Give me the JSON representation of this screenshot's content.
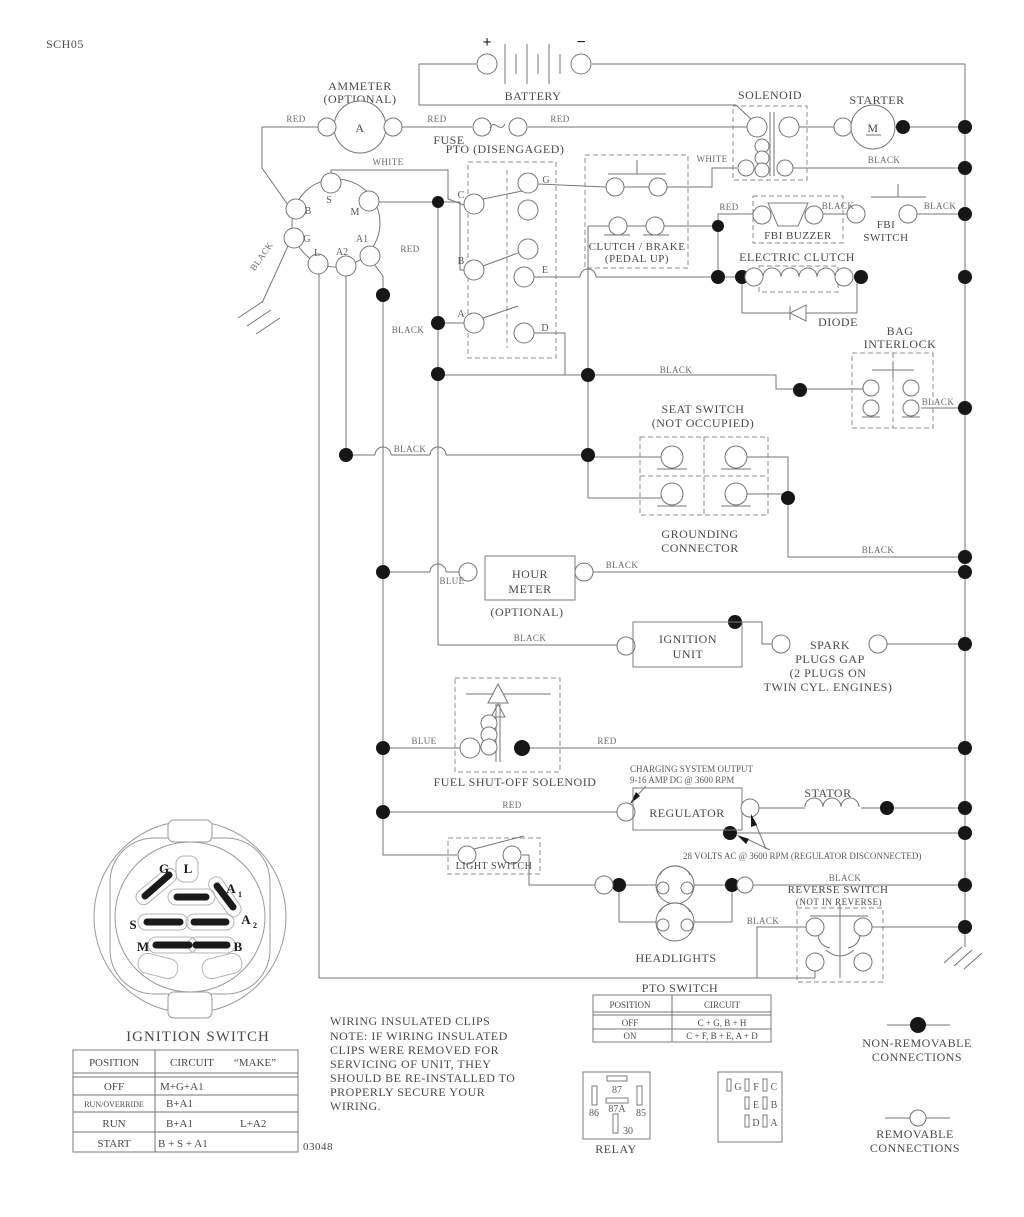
{
  "page": {
    "sch_code": "SCH05",
    "doc_number": "03048"
  },
  "battery": {
    "label": "BATTERY",
    "plus": "+",
    "minus": "−"
  },
  "ammeter": {
    "line1": "AMMETER",
    "line2": "(OPTIONAL)",
    "symbol": "A"
  },
  "fuse": {
    "label": "FUSE"
  },
  "pto": {
    "label": "PTO (DISENGAGED)",
    "pin_c": "C",
    "pin_b": "B",
    "pin_a": "A",
    "pin_g": "G",
    "pin_e": "E",
    "pin_d": "D"
  },
  "solenoid": {
    "label": "SOLENOID"
  },
  "starter": {
    "label": "STARTER",
    "symbol": "M"
  },
  "fbi_buzzer": {
    "label": "FBI BUZZER"
  },
  "fbi_switch": {
    "line1": "FBI",
    "line2": "SWITCH"
  },
  "clutch_brake": {
    "line1": "CLUTCH / BRAKE",
    "line2": "(PEDAL UP)"
  },
  "electric_clutch": {
    "label": "ELECTRIC CLUTCH"
  },
  "diode": {
    "label": "DIODE"
  },
  "bag_interlock": {
    "line1": "BAG",
    "line2": "INTERLOCK"
  },
  "seat_switch": {
    "line1": "SEAT SWITCH",
    "line2": "(NOT OCCUPIED)"
  },
  "grounding_connector": {
    "line1": "GROUNDING",
    "line2": "CONNECTOR"
  },
  "hour_meter": {
    "line1": "HOUR",
    "line2": "METER",
    "note": "(OPTIONAL)"
  },
  "ignition_unit": {
    "line1": "IGNITION",
    "line2": "UNIT"
  },
  "spark_plugs": {
    "line1": "SPARK",
    "line2": "PLUGS GAP",
    "line3": "(2 PLUGS ON",
    "line4": "TWIN CYL. ENGINES)"
  },
  "fuel_solenoid": {
    "label": "FUEL SHUT-OFF SOLENOID"
  },
  "regulator": {
    "label": "REGULATOR"
  },
  "stator": {
    "label": "STATOR"
  },
  "charging_note": {
    "line1": "CHARGING SYSTEM OUTPUT",
    "line2": "9-16 AMP DC @ 3600 RPM"
  },
  "volts_note": {
    "label": "28 VOLTS AC @ 3600 RPM (REGULATOR DISCONNECTED)"
  },
  "light_switch": {
    "label": "LIGHT SWITCH"
  },
  "headlights": {
    "label": "HEADLIGHTS"
  },
  "reverse_switch": {
    "line1": "REVERSE SWITCH",
    "line2": "(NOT IN REVERSE)"
  },
  "ignition_connector": {
    "pin_s": "S",
    "pin_m": "M",
    "pin_b": "B",
    "pin_g": "G",
    "pin_l": "L",
    "pin_a2": "A2",
    "pin_a1": "A1"
  },
  "ignition_face": {
    "title": "IGNITION SWITCH",
    "pin_g": "G",
    "pin_l": "L",
    "pin_a": "A",
    "sub_1": "1",
    "sub_2": "2",
    "pin_s": "S",
    "pin_m": "M",
    "pin_b": "B"
  },
  "ignition_table": {
    "h_position": "POSITION",
    "h_circuit": "CIRCUIT",
    "h_make": "“MAKE”",
    "rows": [
      {
        "position": "OFF",
        "circuit": "M+G+A1",
        "make": ""
      },
      {
        "position": "RUN/OVERRIDE",
        "circuit": "B+A1",
        "make": ""
      },
      {
        "position": "RUN",
        "circuit": "B+A1",
        "make": "L+A2"
      },
      {
        "position": "START",
        "circuit": "B + S + A1",
        "make": ""
      }
    ]
  },
  "wiring_note": {
    "lines": [
      "WIRING INSULATED CLIPS",
      "NOTE: IF WIRING INSULATED",
      "CLIPS WERE REMOVED FOR",
      "SERVICING OF UNIT, THEY",
      "SHOULD BE RE-INSTALLED TO",
      "PROPERLY SECURE YOUR",
      "WIRING."
    ]
  },
  "pto_table": {
    "title": "PTO SWITCH",
    "h_position": "POSITION",
    "h_circuit": "CIRCUIT",
    "rows": [
      {
        "position": "OFF",
        "circuit": "C + G, B + H"
      },
      {
        "position": "ON",
        "circuit": "C + F, B + E, A + D"
      }
    ]
  },
  "relay": {
    "label": "RELAY",
    "pin_87": "87",
    "pin_87a": "87A",
    "pin_86": "86",
    "pin_85": "85",
    "pin_30": "30"
  },
  "plug": {
    "pin_g": "G",
    "pin_f": "F",
    "pin_c": "C",
    "pin_e": "E",
    "pin_b": "B",
    "pin_d": "D",
    "pin_a": "A"
  },
  "legend": {
    "non_removable_line1": "NON-REMOVABLE",
    "non_removable_line2": "CONNECTIONS",
    "removable_line1": "REMOVABLE",
    "removable_line2": "CONNECTIONS"
  },
  "wire_labels": [
    {
      "text": "RED"
    },
    {
      "text": "RED"
    },
    {
      "text": "RED"
    },
    {
      "text": "WHITE"
    },
    {
      "text": "WHITE"
    },
    {
      "text": "BLACK"
    },
    {
      "text": "RED"
    },
    {
      "text": "BLACK"
    },
    {
      "text": "BLACK"
    },
    {
      "text": "BLACK"
    },
    {
      "text": "RED"
    },
    {
      "text": "BLACK"
    },
    {
      "text": "BLACK"
    },
    {
      "text": "BLACK"
    },
    {
      "text": "BLACK"
    },
    {
      "text": "BLACK"
    },
    {
      "text": "BLUE"
    },
    {
      "text": "BLACK"
    },
    {
      "text": "BLACK"
    },
    {
      "text": "BLUE"
    },
    {
      "text": "RED"
    },
    {
      "text": "RED"
    },
    {
      "text": "BLACK"
    },
    {
      "text": "BLACK"
    }
  ]
}
